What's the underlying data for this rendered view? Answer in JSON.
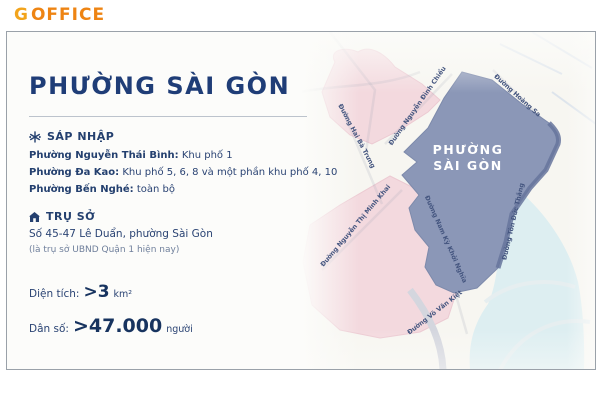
{
  "logo": {
    "g": "G",
    "office": "OFFICE"
  },
  "title": "PHƯỜNG SÀI GÒN",
  "sections": {
    "merge": {
      "heading": "SÁP NHẬP",
      "items": [
        {
          "name": "Phường Nguyễn Thái Bình:",
          "detail": " Khu phố 1"
        },
        {
          "name": "Phường Đa Kao:",
          "detail": " Khu phố 5, 6, 8 và một phần khu phố 4, 10"
        },
        {
          "name": "Phường Bến Nghé:",
          "detail": " toàn bộ"
        }
      ]
    },
    "headquarters": {
      "heading": "TRỤ SỞ",
      "address": "Số 45-47 Lê Duẩn, phường Sài Gòn",
      "note": "(là trụ sở UBND Quận 1 hiện nay)"
    },
    "area": {
      "label": "Diện tích:",
      "value": ">3",
      "unit": "km²"
    },
    "population": {
      "label": "Dân số:",
      "value": ">47.000",
      "unit": "người"
    }
  },
  "map": {
    "region_label_line1": "PHƯỜNG",
    "region_label_line2": "SÀI GÒN",
    "streets": [
      "Đường Nguyễn Đình Chiểu",
      "Đường Hai Bà Trưng",
      "Đường Hoàng Sa",
      "Đường Nguyễn Thị Minh Khai",
      "Đường Nam Kỳ Khởi Nghĩa",
      "Đường Tôn Đức Thắng",
      "Đường Võ Văn Kiệt"
    ]
  },
  "colors": {
    "navy_text": "#24406f",
    "logo_g": "#f2a41c",
    "logo_office": "#ee8413",
    "ward_blue": "#8b97b7",
    "former_ward_pink": "#f3d9de",
    "river": "#ddeef1"
  }
}
